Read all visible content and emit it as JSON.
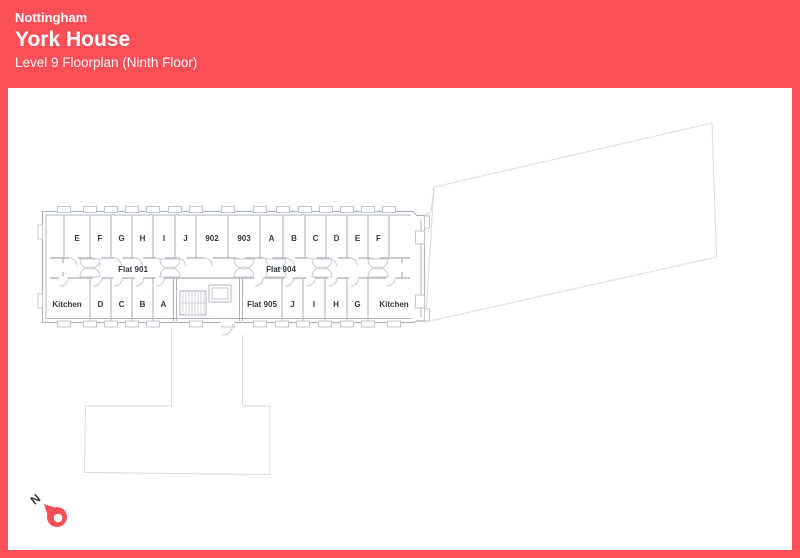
{
  "header": {
    "city": "Nottingham",
    "building": "York House",
    "subtitle": "Level 9 Floorplan (Ninth Floor)"
  },
  "colors": {
    "accent": "#FB4F58",
    "wall": "#AEB3BC",
    "partition": "#C8CCD3",
    "faint_outline": "#DBDCE1",
    "label_text": "#343940",
    "background": "#FFFFFF"
  },
  "floorplan": {
    "rooms_top": [
      "E",
      "F",
      "G",
      "H",
      "I",
      "J",
      "902",
      "903",
      "A",
      "B",
      "C",
      "D",
      "E",
      "F"
    ],
    "rooms_bottom": [
      "Kitchen",
      "D",
      "C",
      "B",
      "A",
      "Flat 905",
      "J",
      "I",
      "H",
      "G",
      "Kitchen"
    ],
    "corridor_flats": [
      "Flat 901",
      "Flat 904"
    ]
  },
  "compass": {
    "north_label": "N"
  }
}
